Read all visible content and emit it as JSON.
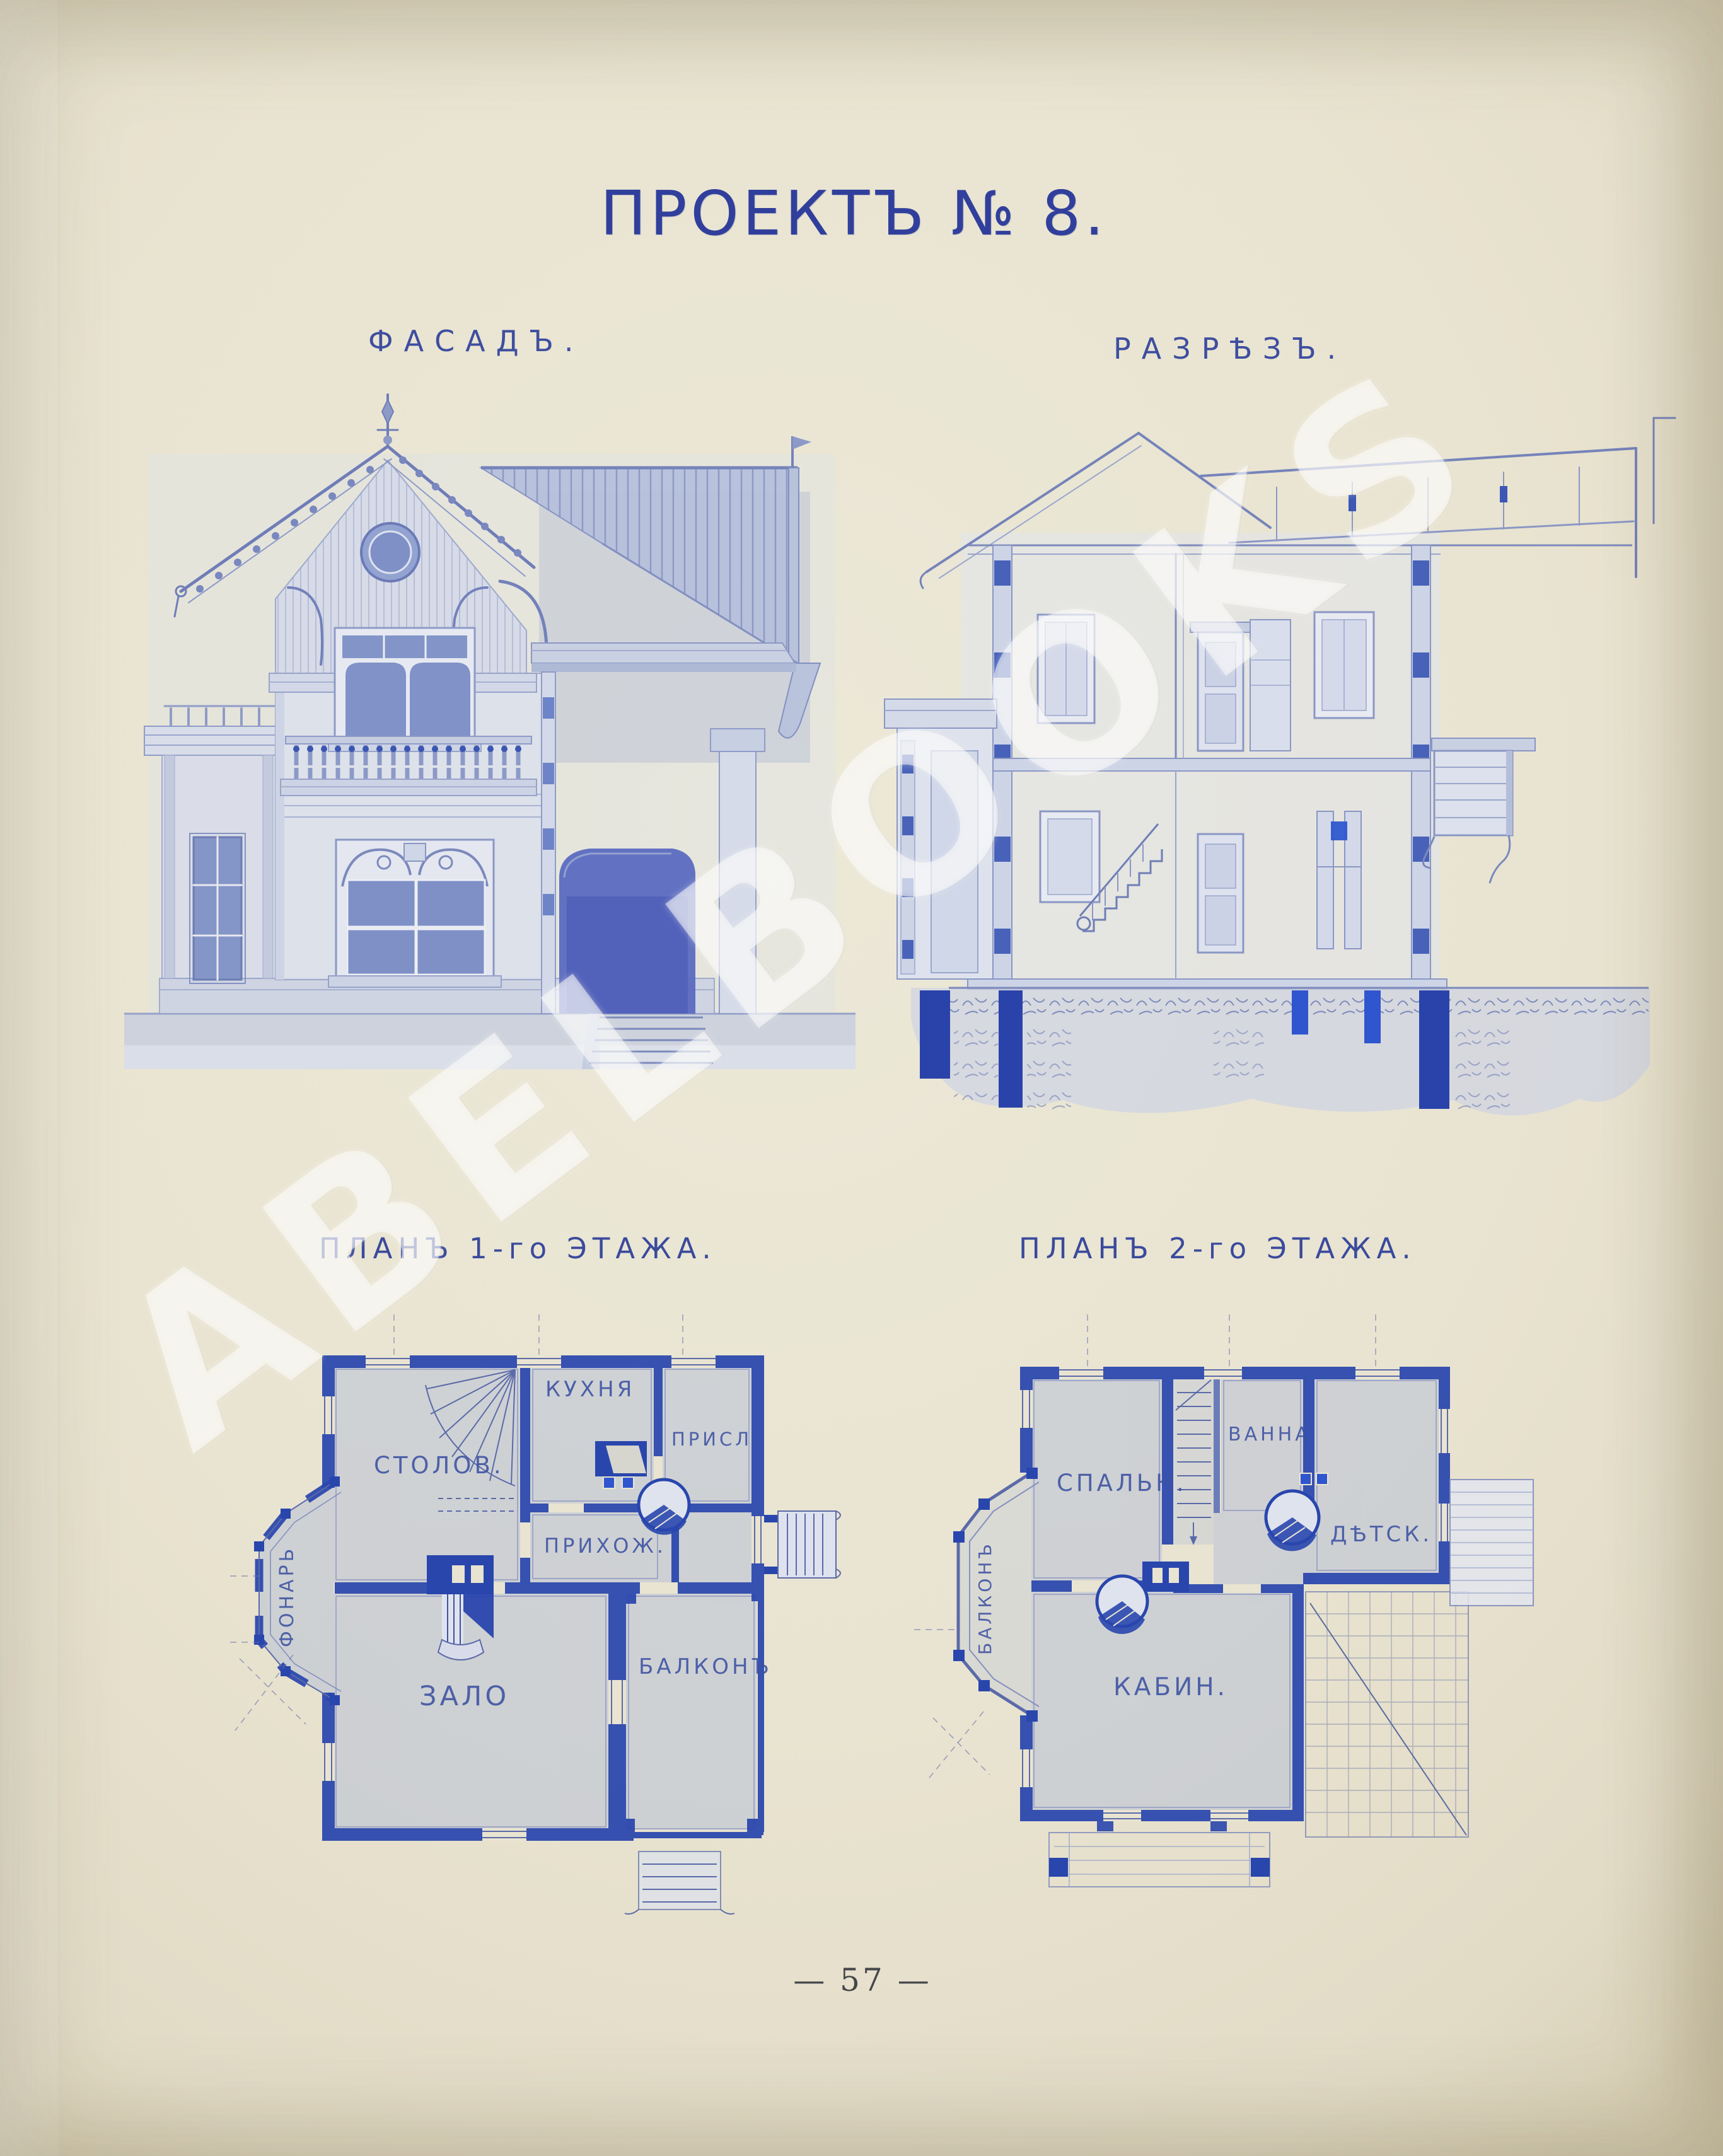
{
  "page": {
    "title": "ПРОЕКТЪ  №  8.",
    "page_number": "57",
    "page_number_display": "— 57 —",
    "watermark": "ABELBOOKS",
    "colors": {
      "ink": "#32439b",
      "paper": "#e9e4d1",
      "wall_blue": "#2946ad"
    }
  },
  "drawings": {
    "facade": {
      "label": "ФАСАДЪ."
    },
    "section": {
      "label": "РАЗРѢЗЪ."
    },
    "plan1": {
      "label": "ПЛАНЪ 1-го ЭТАЖА.",
      "rooms": [
        {
          "name": "СТОЛОВ."
        },
        {
          "name": "КУХНЯ"
        },
        {
          "name": "ПРИСЛ."
        },
        {
          "name": "ПРИХОЖ."
        },
        {
          "name": "ЗАЛО"
        },
        {
          "name": "БАЛКОНЪ"
        },
        {
          "name": "ФОНАРЬ",
          "orientation": "vertical"
        }
      ]
    },
    "plan2": {
      "label": "ПЛАНЪ 2-го ЭТАЖА.",
      "rooms": [
        {
          "name": "СПАЛЬН."
        },
        {
          "name": "ВАННА"
        },
        {
          "name": "ДѢТСК."
        },
        {
          "name": "КАБИН."
        },
        {
          "name": "БАЛКОНЪ",
          "orientation": "vertical"
        }
      ]
    }
  }
}
